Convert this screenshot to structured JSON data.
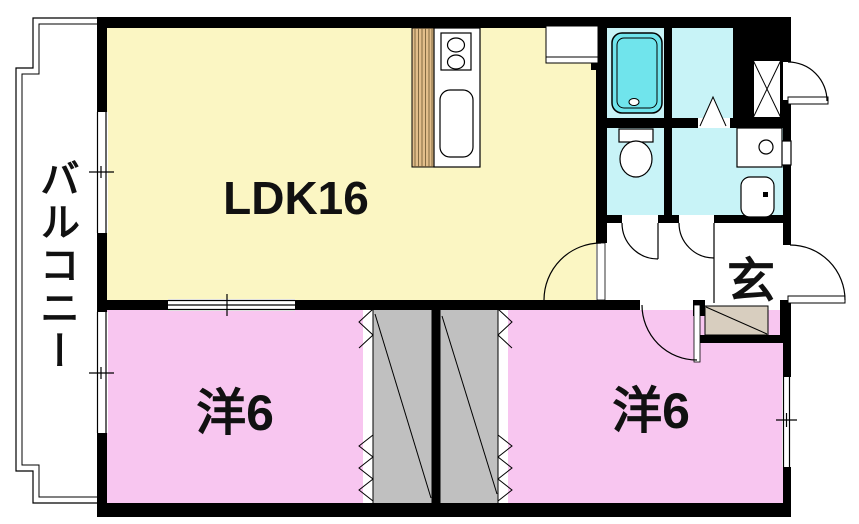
{
  "page": {
    "background": "#ffffff"
  },
  "floorplan": {
    "labels": {
      "balcony": "バルコニー",
      "ldk": "LDK16",
      "bedroom_left": "洋6",
      "bedroom_right": "洋6",
      "entrance": "玄"
    },
    "colors": {
      "ldk": "#FBF6C3",
      "bedroom": "#F8C6F0",
      "wet_room": "#C8F3F7",
      "bathtub": "#70E4EC",
      "closet": "#C0C0C0",
      "entrance_step": "#D8CEBF",
      "kitchen_counter": "#E2BE8B",
      "wall": "#000000",
      "floor": "#FFFFFF"
    },
    "fixtures": [
      "bathtub",
      "toilet",
      "washbasin",
      "washing-machine",
      "gas-stove",
      "kitchen-sink",
      "kitchen-counter",
      "refrigerator-space",
      "pipe-space",
      "entrance-step",
      "closet-left",
      "closet-right",
      "balcony-railing",
      "door-swing-arcs",
      "sliding-windows",
      "folding-doors"
    ]
  }
}
